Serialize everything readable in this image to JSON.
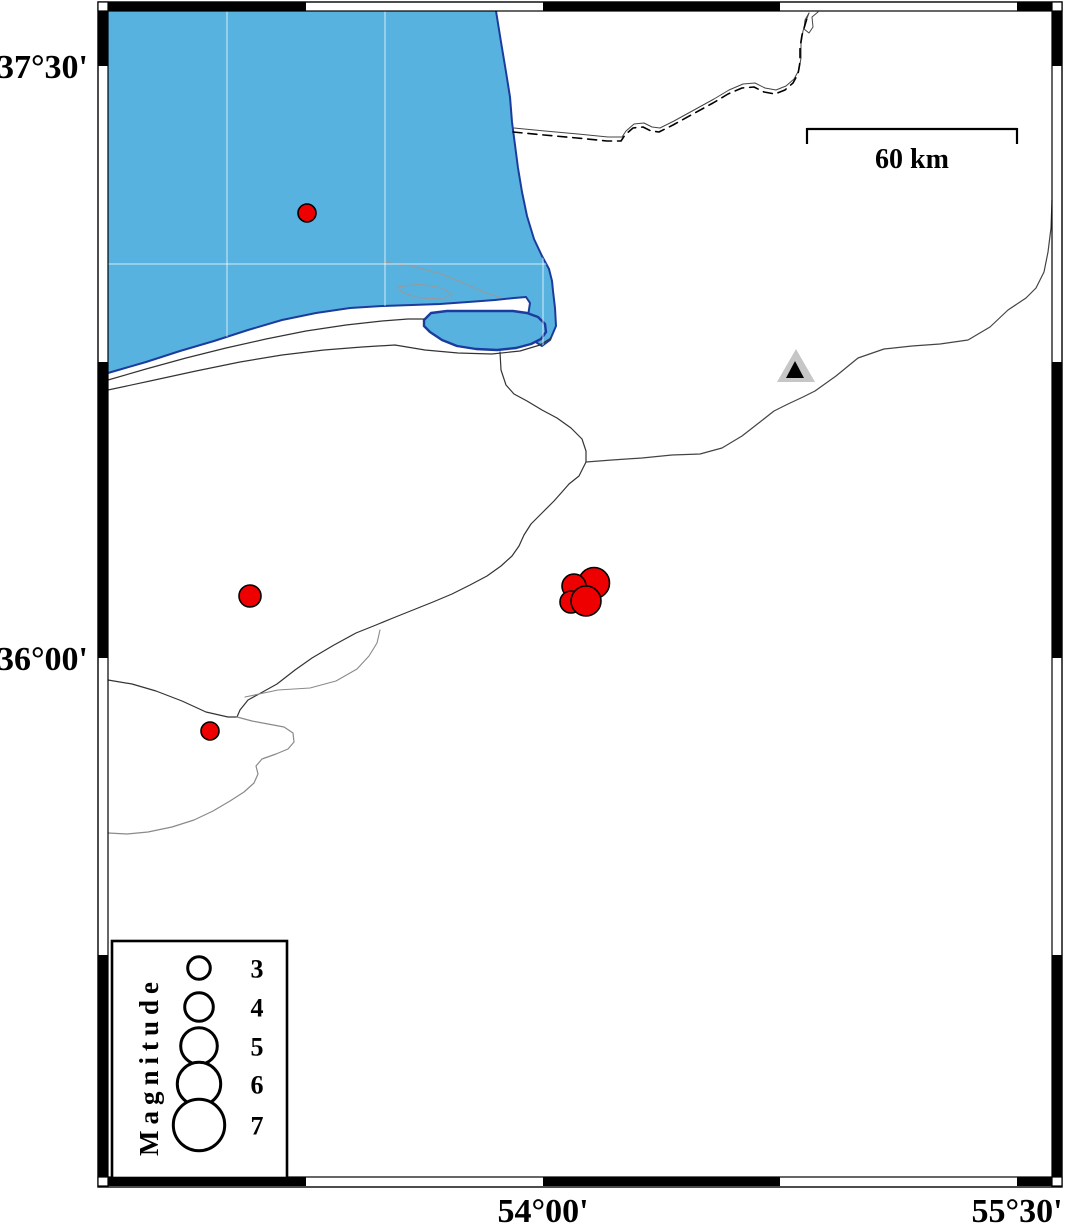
{
  "figure_type": "seismicity_map",
  "colors": {
    "sea": "#58B2E0",
    "sea_outline": "#1b3c9c",
    "land_line": "#333333",
    "river_gray": "#8a8a8a",
    "lagoon_gray": "#999999",
    "border_line": "#444444",
    "grid_line": "rgba(255,255,255,0.75)",
    "quake_fill": "#ee0000",
    "quake_stroke": "#000000",
    "station_outer": "#c6c6c6",
    "station_inner": "#000000",
    "frame_black": "#000000",
    "frame_white": "#ffffff"
  },
  "axis": {
    "labels": [
      {
        "text": "37°30'",
        "side": "left",
        "x": 88,
        "y": 78,
        "anchor": "end"
      },
      {
        "text": "36°00'",
        "side": "left",
        "x": 88,
        "y": 670,
        "anchor": "end"
      },
      {
        "text": "54°00'",
        "side": "bottom",
        "x": 543,
        "y": 1222,
        "anchor": "middle"
      },
      {
        "text": "55°30'",
        "side": "bottom",
        "x": 1017,
        "y": 1222,
        "anchor": "middle"
      }
    ]
  },
  "frame": {
    "outer": [
      98,
      2,
      964,
      1185
    ],
    "inner": [
      108,
      11,
      944,
      1166
    ],
    "top_black_x": [
      [
        108,
        306
      ],
      [
        543,
        780
      ],
      [
        1017,
        1052
      ]
    ],
    "bottom_black_x": [
      [
        108,
        306
      ],
      [
        543,
        780
      ],
      [
        1017,
        1052
      ]
    ],
    "left_black_y": [
      [
        11,
        66
      ],
      [
        362,
        658
      ],
      [
        955,
        1177
      ]
    ],
    "right_black_y": [
      [
        11,
        66
      ],
      [
        362,
        658
      ],
      [
        955,
        1177
      ]
    ],
    "corner_squares": [
      [
        98,
        2
      ],
      [
        1052,
        2
      ],
      [
        98,
        1177
      ],
      [
        1052,
        1177
      ]
    ],
    "band_w": 10,
    "band_h": 9
  },
  "grid": {
    "vertical_x": [
      227,
      385,
      543
    ],
    "horizontal_y": [
      264
    ],
    "y_range": [
      11,
      355
    ],
    "x_range": [
      108,
      560
    ]
  },
  "geography": {
    "sea_polygon": [
      [
        108,
        11
      ],
      [
        496,
        11
      ],
      [
        501,
        42
      ],
      [
        506,
        72
      ],
      [
        510,
        97
      ],
      [
        512,
        122
      ],
      [
        515,
        145
      ],
      [
        518,
        168
      ],
      [
        522,
        192
      ],
      [
        527,
        216
      ],
      [
        534,
        239
      ],
      [
        542,
        256
      ],
      [
        549,
        269
      ],
      [
        552,
        281
      ],
      [
        553,
        291
      ],
      [
        555,
        308
      ],
      [
        556,
        326
      ],
      [
        550,
        340
      ],
      [
        542,
        346
      ],
      [
        534,
        341
      ],
      [
        529,
        331
      ],
      [
        528,
        316
      ],
      [
        530,
        303
      ],
      [
        526,
        297
      ],
      [
        514,
        298
      ],
      [
        495,
        300
      ],
      [
        468,
        302
      ],
      [
        440,
        304
      ],
      [
        412,
        305
      ],
      [
        383,
        306
      ],
      [
        350,
        308
      ],
      [
        316,
        313
      ],
      [
        282,
        320
      ],
      [
        248,
        330
      ],
      [
        214,
        341
      ],
      [
        180,
        351
      ],
      [
        146,
        362
      ],
      [
        108,
        373
      ]
    ],
    "bay_polygon": [
      [
        424,
        320
      ],
      [
        431,
        313
      ],
      [
        447,
        311
      ],
      [
        468,
        311
      ],
      [
        492,
        311
      ],
      [
        513,
        311
      ],
      [
        527,
        313
      ],
      [
        538,
        317
      ],
      [
        545,
        324
      ],
      [
        546,
        332
      ],
      [
        541,
        339
      ],
      [
        531,
        344
      ],
      [
        516,
        348
      ],
      [
        497,
        350
      ],
      [
        476,
        349
      ],
      [
        457,
        346
      ],
      [
        442,
        340
      ],
      [
        430,
        332
      ],
      [
        424,
        326
      ]
    ],
    "lines": [
      {
        "name": "spit-south-shore",
        "color": "land_line",
        "w": 1.2,
        "pts": [
          [
            108,
            380
          ],
          [
            146,
            369
          ],
          [
            186,
            358
          ],
          [
            226,
            348
          ],
          [
            266,
            339
          ],
          [
            306,
            331
          ],
          [
            346,
            325
          ],
          [
            382,
            321
          ],
          [
            408,
            319
          ],
          [
            424,
            319
          ]
        ]
      },
      {
        "name": "mainland-coast",
        "color": "land_line",
        "w": 1.2,
        "pts": [
          [
            108,
            390
          ],
          [
            150,
            381
          ],
          [
            196,
            371
          ],
          [
            240,
            362
          ],
          [
            282,
            355
          ],
          [
            324,
            350
          ],
          [
            362,
            347
          ],
          [
            395,
            345
          ],
          [
            425,
            350
          ],
          [
            458,
            353
          ],
          [
            492,
            354
          ],
          [
            520,
            351
          ],
          [
            540,
            345
          ],
          [
            551,
            338
          ]
        ]
      },
      {
        "name": "lagoon-channel",
        "color": "lagoon_gray",
        "w": 1,
        "pts": [
          [
            383,
            262
          ],
          [
            412,
            266
          ],
          [
            441,
            274
          ],
          [
            466,
            284
          ],
          [
            486,
            293
          ],
          [
            500,
            297
          ]
        ]
      },
      {
        "name": "lagoon-pond",
        "color": "lagoon_gray",
        "w": 1,
        "pts": [
          [
            398,
            287
          ],
          [
            420,
            284
          ],
          [
            442,
            288
          ],
          [
            452,
            294
          ],
          [
            443,
            299
          ],
          [
            420,
            298
          ],
          [
            403,
            293
          ],
          [
            398,
            287
          ]
        ]
      },
      {
        "name": "river-from-bay",
        "color": "land_line",
        "w": 1.2,
        "pts": [
          [
            500,
            352
          ],
          [
            501,
            370
          ],
          [
            506,
            385
          ],
          [
            514,
            394
          ],
          [
            527,
            401
          ],
          [
            542,
            410
          ],
          [
            557,
            418
          ],
          [
            571,
            428
          ],
          [
            582,
            439
          ],
          [
            586,
            451
          ],
          [
            586,
            462
          ]
        ]
      },
      {
        "name": "river-east",
        "color": "border_line",
        "w": 1.2,
        "pts": [
          [
            586,
            462
          ],
          [
            612,
            460
          ],
          [
            642,
            458
          ],
          [
            672,
            455
          ],
          [
            700,
            454
          ],
          [
            722,
            448
          ],
          [
            742,
            436
          ],
          [
            760,
            422
          ],
          [
            774,
            411
          ],
          [
            788,
            404
          ],
          [
            803,
            397
          ],
          [
            815,
            391
          ],
          [
            836,
            376
          ],
          [
            858,
            358
          ],
          [
            884,
            349
          ],
          [
            912,
            346
          ],
          [
            940,
            344
          ],
          [
            968,
            340
          ],
          [
            990,
            327
          ],
          [
            1008,
            310
          ],
          [
            1020,
            302
          ],
          [
            1026,
            298
          ],
          [
            1036,
            288
          ],
          [
            1044,
            272
          ],
          [
            1048,
            252
          ],
          [
            1051,
            228
          ],
          [
            1052,
            200
          ]
        ]
      },
      {
        "name": "coast-southwest",
        "color": "land_line",
        "w": 1.2,
        "pts": [
          [
            586,
            462
          ],
          [
            579,
            476
          ],
          [
            569,
            484
          ],
          [
            562,
            492
          ],
          [
            554,
            501
          ],
          [
            542,
            513
          ],
          [
            531,
            524
          ],
          [
            524,
            535
          ],
          [
            519,
            546
          ],
          [
            512,
            556
          ],
          [
            501,
            566
          ],
          [
            487,
            576
          ],
          [
            470,
            585
          ],
          [
            452,
            594
          ],
          [
            433,
            602
          ],
          [
            413,
            610
          ],
          [
            393,
            618
          ],
          [
            376,
            625
          ],
          [
            356,
            633
          ],
          [
            334,
            645
          ],
          [
            312,
            658
          ],
          [
            295,
            670
          ],
          [
            277,
            684
          ],
          [
            259,
            694
          ],
          [
            248,
            700
          ],
          [
            240,
            710
          ],
          [
            237,
            717
          ]
        ]
      },
      {
        "name": "line-to-west-edge",
        "color": "land_line",
        "w": 1.2,
        "pts": [
          [
            108,
            680
          ],
          [
            132,
            684
          ],
          [
            156,
            691
          ],
          [
            182,
            701
          ],
          [
            206,
            712
          ],
          [
            228,
            717
          ],
          [
            237,
            717
          ]
        ]
      },
      {
        "name": "river-fork",
        "color": "river_gray",
        "w": 1.1,
        "pts": [
          [
            245,
            697
          ],
          [
            278,
            690
          ],
          [
            310,
            688
          ],
          [
            336,
            681
          ],
          [
            357,
            669
          ],
          [
            369,
            656
          ],
          [
            377,
            643
          ],
          [
            380,
            630
          ]
        ]
      },
      {
        "name": "river-southeast",
        "color": "river_gray",
        "w": 1.2,
        "pts": [
          [
            237,
            717
          ],
          [
            252,
            721
          ],
          [
            268,
            724
          ],
          [
            284,
            727
          ],
          [
            293,
            733
          ],
          [
            294,
            742
          ],
          [
            288,
            749
          ],
          [
            276,
            754
          ],
          [
            262,
            759
          ],
          [
            256,
            766
          ],
          [
            258,
            774
          ],
          [
            254,
            783
          ],
          [
            244,
            792
          ],
          [
            230,
            801
          ],
          [
            213,
            811
          ],
          [
            194,
            820
          ],
          [
            172,
            827
          ],
          [
            148,
            832
          ],
          [
            127,
            834
          ],
          [
            108,
            833
          ]
        ]
      },
      {
        "name": "border-river-solid",
        "color": "border_line",
        "w": 1,
        "pts": [
          [
            514,
            128
          ],
          [
            545,
            131
          ],
          [
            578,
            134
          ],
          [
            608,
            137
          ],
          [
            622,
            137
          ],
          [
            626,
            131
          ],
          [
            634,
            124
          ],
          [
            644,
            123
          ],
          [
            652,
            127
          ],
          [
            660,
            128
          ],
          [
            674,
            121
          ],
          [
            694,
            110
          ],
          [
            714,
            99
          ],
          [
            729,
            90
          ],
          [
            743,
            84
          ],
          [
            755,
            83
          ],
          [
            765,
            88
          ],
          [
            776,
            90
          ],
          [
            786,
            86
          ],
          [
            794,
            79
          ],
          [
            799,
            70
          ],
          [
            801,
            58
          ],
          [
            801,
            44
          ],
          [
            803,
            31
          ],
          [
            806,
            21
          ],
          [
            809,
            13
          ]
        ]
      },
      {
        "name": "border-hook",
        "color": "border_line",
        "w": 1,
        "pts": [
          [
            809,
            13
          ],
          [
            805,
            20
          ],
          [
            804,
            29
          ],
          [
            809,
            33
          ],
          [
            813,
            27
          ],
          [
            812,
            17
          ],
          [
            818,
            12
          ]
        ]
      },
      {
        "name": "border-dashed",
        "color": "quake_stroke",
        "w": 1.6,
        "dash": "9,6",
        "pts": [
          [
            513,
            132
          ],
          [
            544,
            135
          ],
          [
            577,
            138
          ],
          [
            607,
            141
          ],
          [
            621,
            141
          ],
          [
            625,
            135
          ],
          [
            633,
            128
          ],
          [
            643,
            127
          ],
          [
            651,
            131
          ],
          [
            659,
            132
          ],
          [
            673,
            125
          ],
          [
            693,
            114
          ],
          [
            713,
            103
          ],
          [
            728,
            94
          ],
          [
            742,
            88
          ],
          [
            754,
            87
          ],
          [
            764,
            92
          ],
          [
            775,
            94
          ],
          [
            785,
            90
          ],
          [
            793,
            83
          ],
          [
            798,
            74
          ],
          [
            800,
            62
          ],
          [
            800,
            48
          ],
          [
            802,
            35
          ],
          [
            805,
            25
          ],
          [
            808,
            15
          ]
        ]
      }
    ]
  },
  "station": {
    "outer_triangle": [
      [
        796,
        349
      ],
      [
        815,
        382
      ],
      [
        777,
        382
      ]
    ],
    "inner_triangle": [
      [
        795,
        361
      ],
      [
        804,
        378
      ],
      [
        786,
        378
      ]
    ]
  },
  "earthquakes": [
    {
      "x": 307,
      "y": 213,
      "r": 9
    },
    {
      "x": 250,
      "y": 596,
      "r": 11
    },
    {
      "x": 210,
      "y": 731,
      "r": 9
    },
    {
      "x": 594,
      "y": 583,
      "r": 15.5
    },
    {
      "x": 574,
      "y": 586,
      "r": 12
    },
    {
      "x": 571,
      "y": 602,
      "r": 11
    },
    {
      "x": 586,
      "y": 601,
      "r": 15
    }
  ],
  "scalebar": {
    "x1": 807,
    "x2": 1017,
    "y": 129,
    "tick_len": 15,
    "stroke_w": 2.2,
    "label": "60 km",
    "label_x": 912,
    "label_y": 168
  },
  "legend": {
    "box": {
      "x": 112,
      "y": 941,
      "w": 175,
      "h": 237,
      "border_w": 2.6
    },
    "title": "Magnitude",
    "title_x": 158,
    "title_y": 1156,
    "circle_x": 199,
    "number_x": 257,
    "circle_stroke_w": 3,
    "entries": [
      {
        "label": "3",
        "cy": 968,
        "r": 11.3
      },
      {
        "label": "4",
        "cy": 1007,
        "r": 14.3
      },
      {
        "label": "5",
        "cy": 1046,
        "r": 18.3
      },
      {
        "label": "6",
        "cy": 1084,
        "r": 21.7
      },
      {
        "label": "7",
        "cy": 1125,
        "r": 25.7
      }
    ]
  }
}
